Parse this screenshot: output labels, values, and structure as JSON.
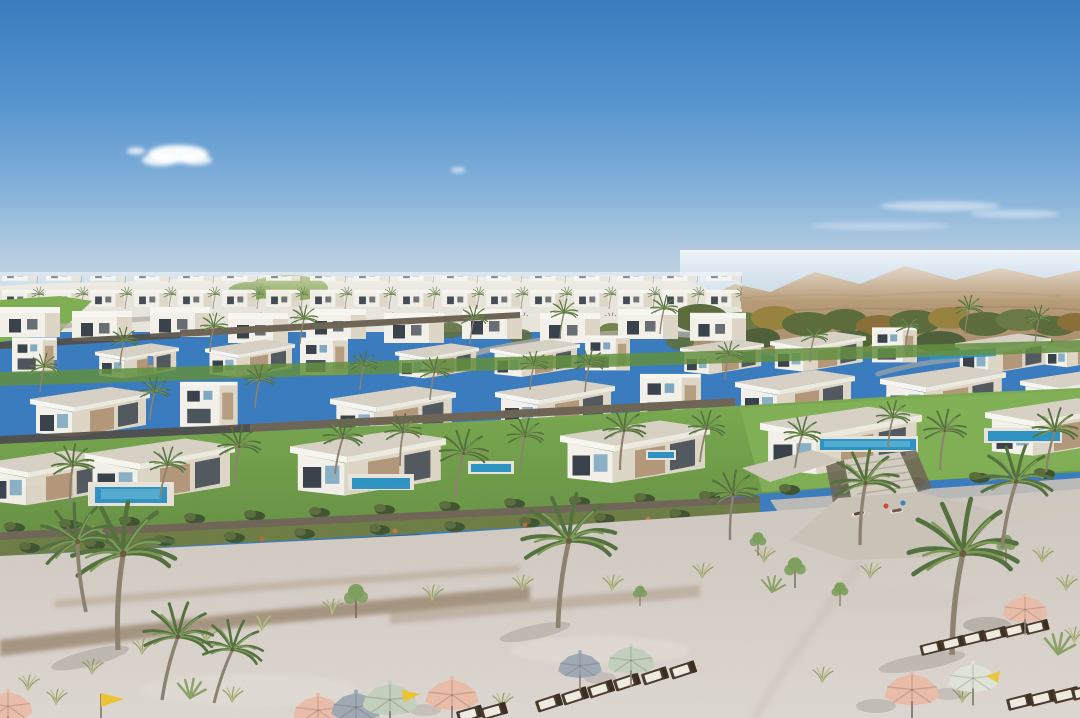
{
  "scene": {
    "title": "Beachfront villa resort — aerial rendering",
    "caption": "Aerial architectural rendering of a beachfront villa community: tiers of white flat-roofed modern villas with wood and glass accents on landscaped terraces, private blue pools, stone retaining walls, palm trees, desert hills on the horizon, and a wide sandy beach with pastel parasols, sun loungers and yellow pennant flags.",
    "setting": {
      "sky": "clear blue with small white clouds and haze at the horizon",
      "background_left": "dense low-rise white village on a gentle hill with a green knoll",
      "background_right": "tan desert mountains with olive and amber trees below",
      "foreground": "pale pink-grey sand beach with dune grass and dirt tracks"
    },
    "villas": {
      "style": "modern flat-roof white villas with timber panels and dark glazing",
      "tiers": 4,
      "pool_count": 7
    },
    "beach": {
      "umbrella_count": 10,
      "umbrella_colors": [
        "pink",
        "sage-green",
        "blue-grey",
        "pale-sage"
      ],
      "lounger_count": 18,
      "pennant_flags": {
        "color": "yellow",
        "count": 2
      },
      "stairway": "stone stairs and paved plaza linking the villas to the beach"
    }
  },
  "palette": {
    "skyTop": "#3a7cbe",
    "skyHigh": "#5795cf",
    "skyMid": "#86b2da",
    "skyLow": "#b5cde1",
    "horizon": "#d9e3e9",
    "cloud": "#ffffff",
    "mountain": "#c0a482",
    "mountainDeep": "#a98f6d",
    "village": "#e7e4db",
    "hillGreen": "#92ac61",
    "treeOlive": "#5c6c3d",
    "treeGreen": "#7f9f5e",
    "treeAmber": "#97833f",
    "hedge": "#3e5330",
    "lawn": "#7cab52",
    "lawnDeep": "#648f41",
    "wall": "#6e6557",
    "wallDark": "#544d42",
    "villaWhite": "#f2f0e9",
    "villaCream": "#ddd5c6",
    "roofGrey": "#d7d1c5",
    "fascia": "#f7f5ef",
    "wood": "#b3977a",
    "glassDark": "#3a434c",
    "glassBlue": "#7fa9c2",
    "pool": "#2f93c2",
    "poolLight": "#62b7d8",
    "sandTop": "#cfc8c1",
    "sandBottom": "#ded8d2",
    "dirt": "#9c8974",
    "dirtLight": "#b3a28d",
    "paving": "#c9c2b7",
    "pavingLight": "#cfc8bc",
    "palmTrunk": "#8d8270",
    "palmGreen": "#55713f",
    "palmLight": "#7e9a58",
    "umbPink": "#e9bba9",
    "umbSage": "#c3cfbd",
    "umbPaleSage": "#dfe2d6",
    "umbBlueGrey": "#9fa9b4",
    "lounger": "#4a3b2c",
    "towel": "#eeeae0",
    "flagYellow": "#ecc433",
    "banner": "#4a7fc0",
    "shadow": "#2f2a22"
  }
}
